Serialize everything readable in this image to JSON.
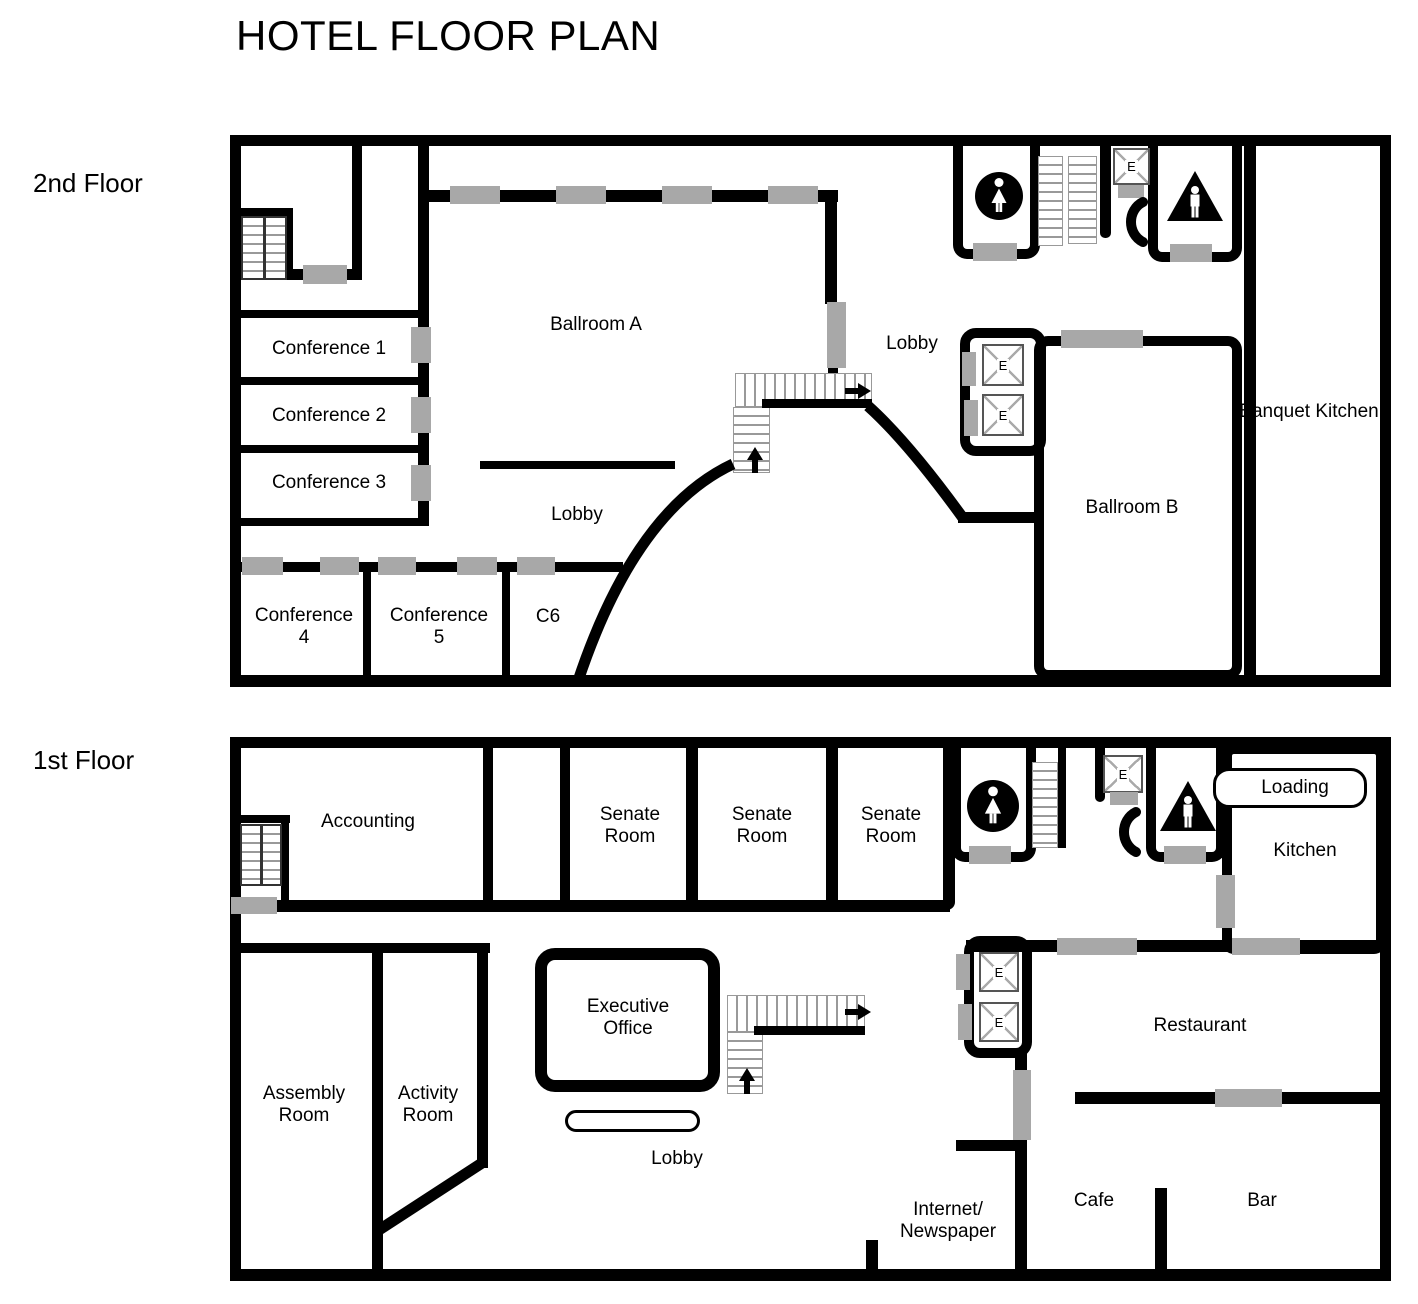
{
  "title": "HOTEL FLOOR PLAN",
  "shared": {
    "elevator_label": "E"
  },
  "floor2": {
    "label": "2nd Floor",
    "rooms": {
      "ballroom_a": "Ballroom A",
      "lobby_upper": "Lobby",
      "lobby_center": "Lobby",
      "conference_1": "Conference 1",
      "conference_2": "Conference 2",
      "conference_3": "Conference 3",
      "conference_4": "Conference 4",
      "conference_5": "Conference 5",
      "c6": "C6",
      "ballroom_b": "Ballroom B",
      "banquet_kitchen": "Banquet Kitchen"
    }
  },
  "floor1": {
    "label": "1st Floor",
    "rooms": {
      "accounting": "Accounting",
      "senate_room_1": "Senate Room",
      "senate_room_2": "Senate Room",
      "senate_room_3": "Senate Room",
      "executive_office": "Executive Office",
      "assembly_room": "Assembly Room",
      "activity_room": "Activity Room",
      "lobby": "Lobby",
      "internet_line1": "Internet/",
      "internet_line2": "Newspaper",
      "cafe": "Cafe",
      "bar": "Bar",
      "restaurant": "Restaurant",
      "kitchen": "Kitchen",
      "loading": "Loading"
    }
  }
}
